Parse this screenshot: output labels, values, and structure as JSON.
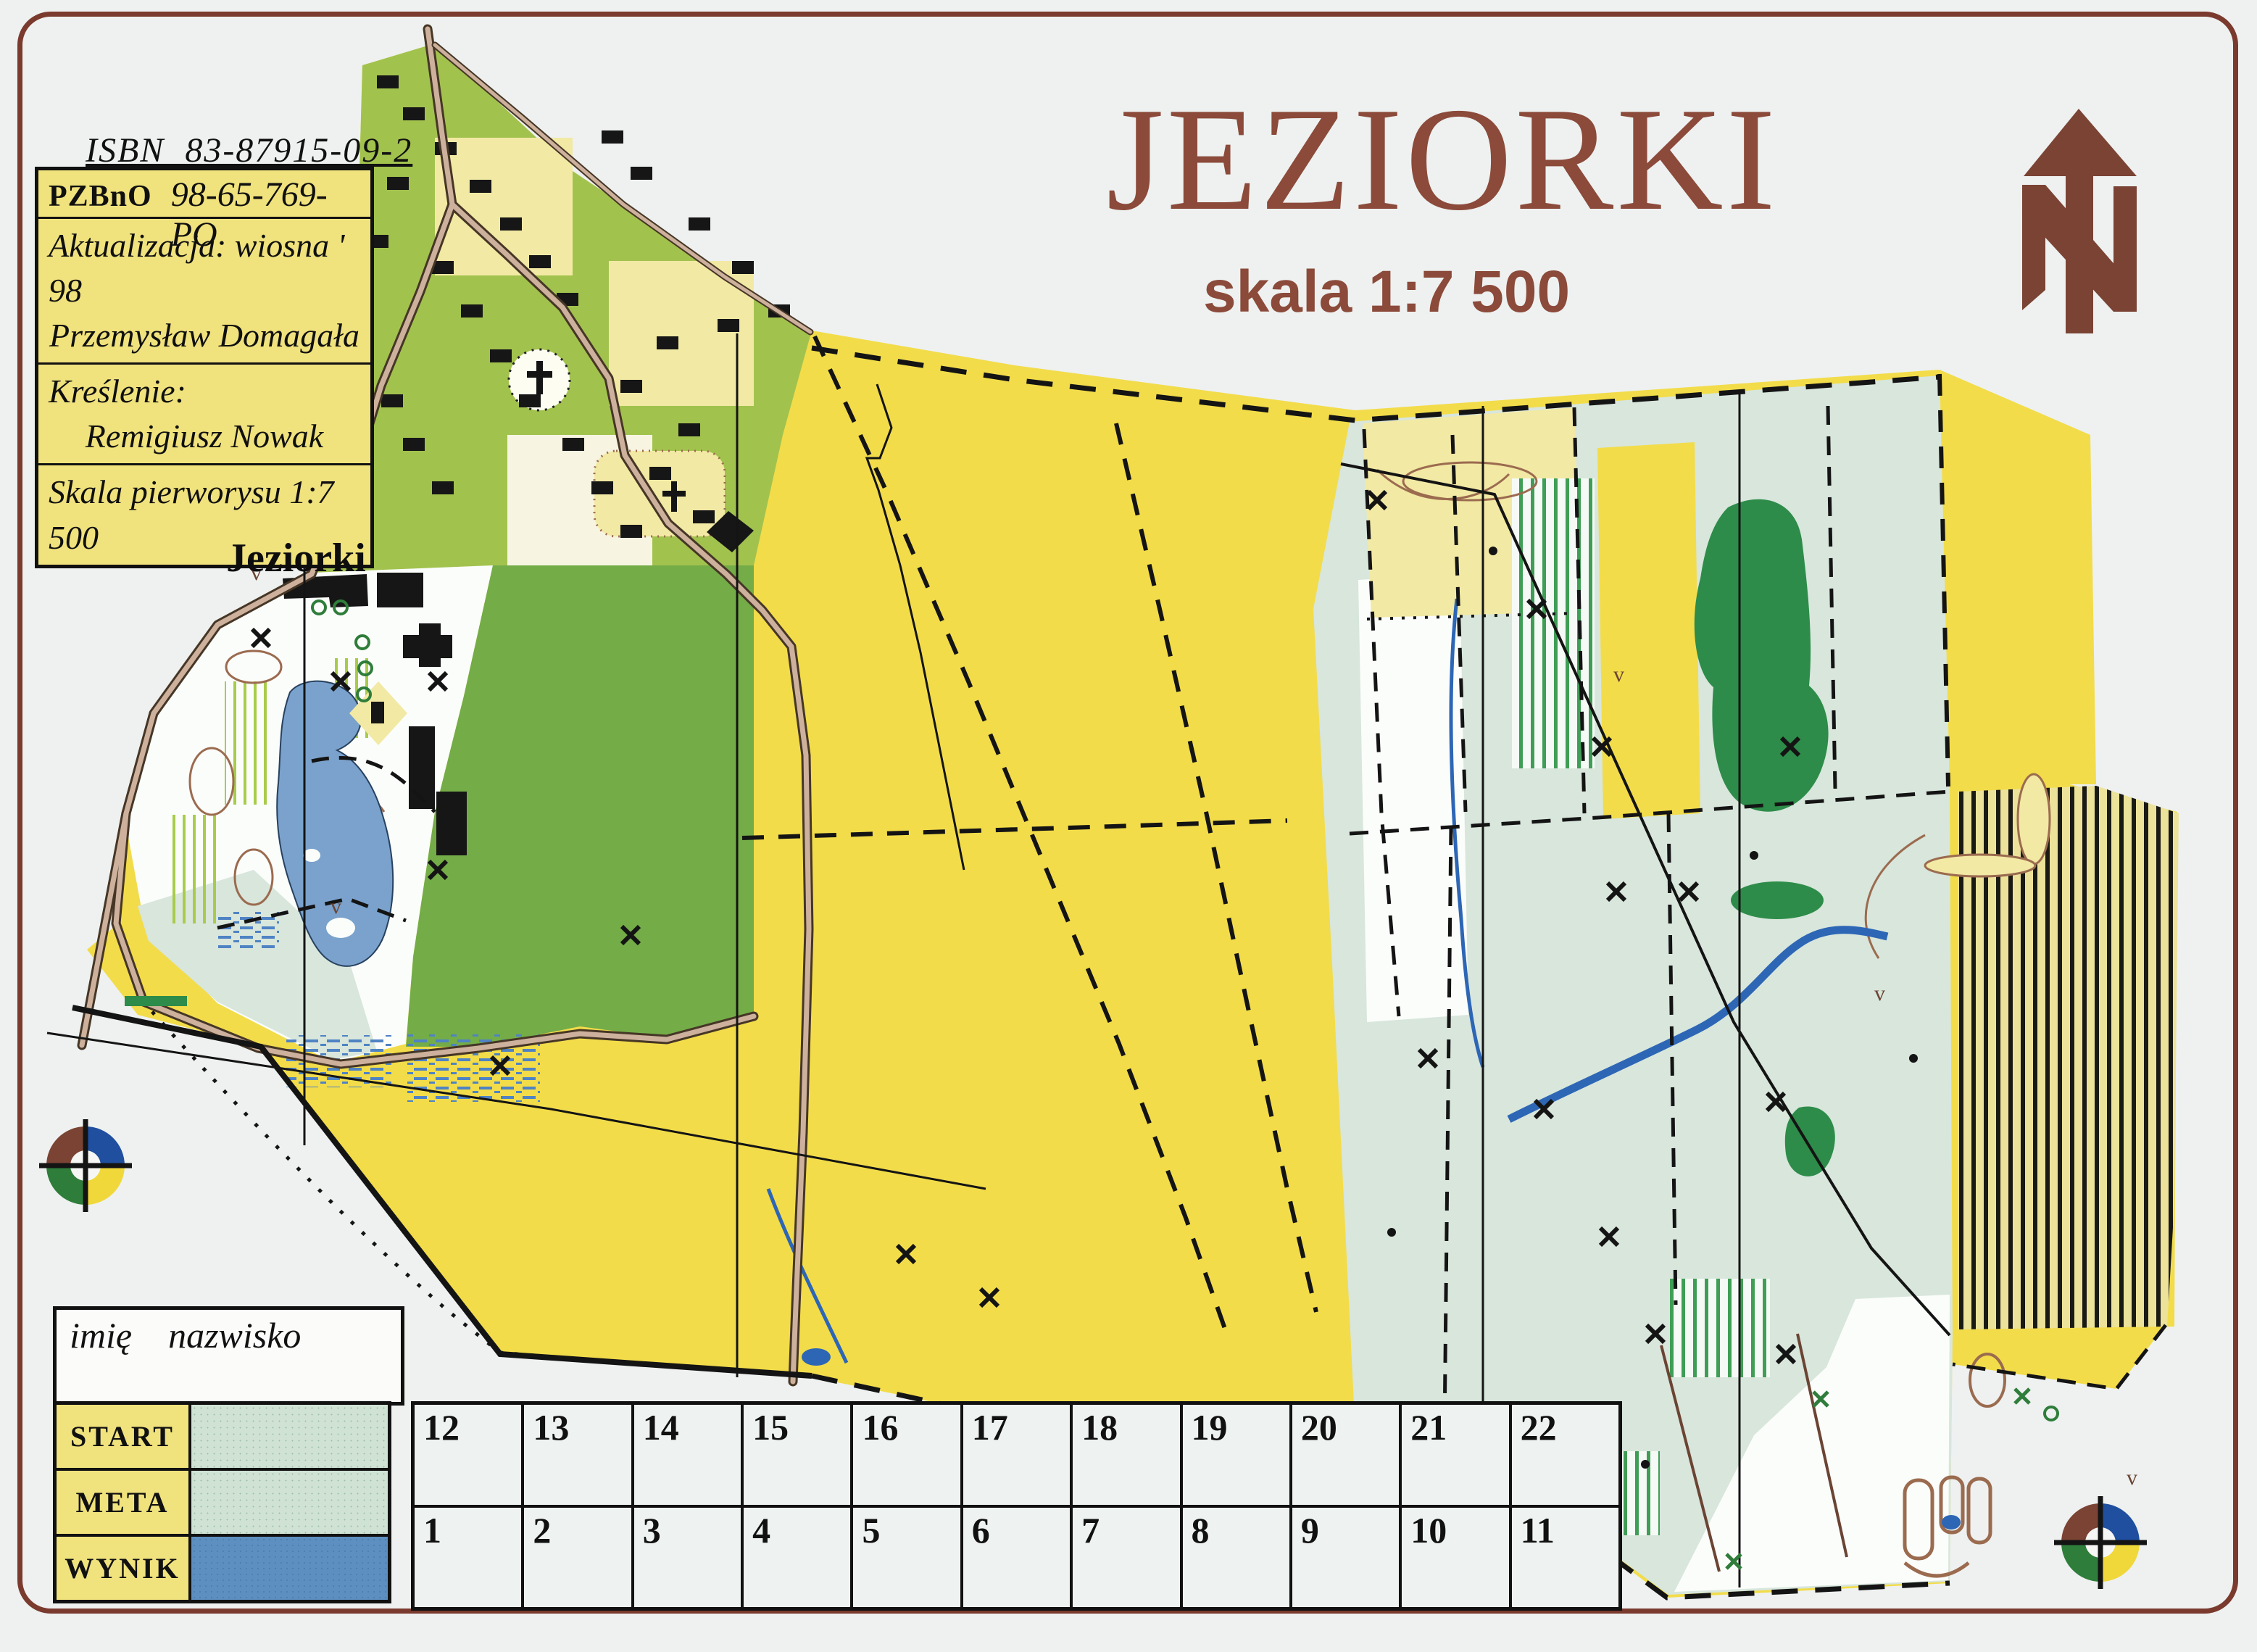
{
  "page": {
    "title": "JEZIORKI",
    "scale_label": "skala 1:7 500",
    "isbn": "ISBN  83-87915-09-2",
    "village_label": "Jeziorki"
  },
  "info_box": {
    "organization": "PZBnO",
    "map_code": "98-65-769-PO",
    "update_line": "Aktualizacja: wiosna ' 98",
    "update_author": "Przemysław Domagała",
    "drawing_label": "Kreślenie:",
    "drawing_author": "Remigiusz Nowak",
    "base_scale_line": "Skala pierworysu 1:7 500"
  },
  "result_card": {
    "name_header": "imię    nazwisko",
    "rows": [
      {
        "label": "START"
      },
      {
        "label": "META"
      },
      {
        "label": "WYNIK"
      }
    ],
    "top_numbers": [
      "12",
      "13",
      "14",
      "15",
      "16",
      "17",
      "18",
      "19",
      "20",
      "21",
      "22"
    ],
    "bottom_numbers": [
      "1",
      "2",
      "3",
      "4",
      "5",
      "6",
      "7",
      "8",
      "9",
      "10",
      "11"
    ]
  },
  "icons": {
    "north_arrow": "north-arrow-with-N-monogram",
    "club_logo": "four-color-orienteering-ring"
  },
  "colors": {
    "paper": "#eef1f0",
    "frame_maroon": "#7a3a2d",
    "title_maroon": "#8b4a3a",
    "map_yellow": "#f2dc4a",
    "pale_yellow": "#f2e9a4",
    "village_olive": "#a2c24e",
    "forest_green": "#74ac48",
    "dark_green": "#2d8c49",
    "pale_teal": "#d8e6dc",
    "stripe_green": "#3f9e55",
    "lake_blue": "#7aa2cc",
    "stream_blue": "#2d66b5",
    "road_fill": "#cdb19d",
    "road_casing": "#463626",
    "contour_brown": "#9b6b4f",
    "table_yellow": "#f0e27d",
    "card_teal": "#cfe2d4",
    "card_blue": "#5d8fc0",
    "ink_black": "#141414",
    "logo_brown": "#7a4334",
    "logo_blue": "#1f4f9e",
    "logo_green": "#2f7d3a",
    "logo_yellow": "#f0d83a"
  }
}
